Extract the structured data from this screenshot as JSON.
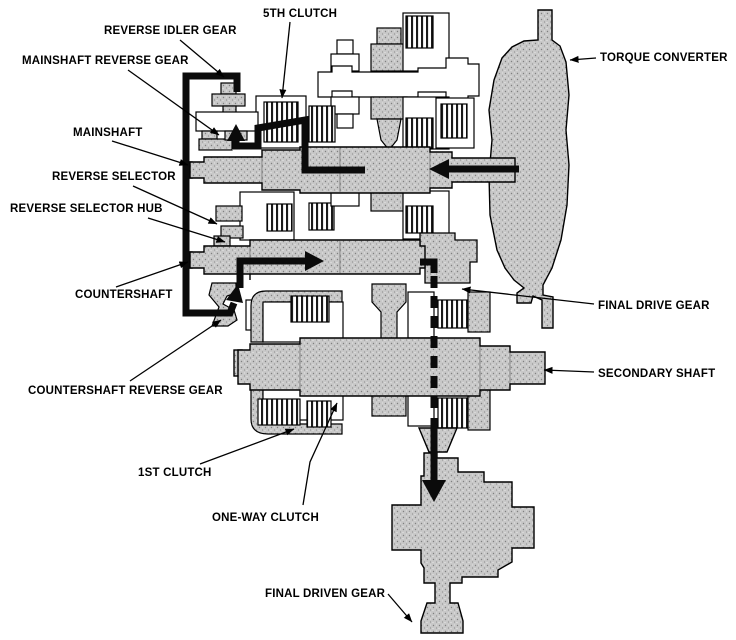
{
  "diagram": {
    "title": "Automatic transmission reverse power-flow cross-section",
    "colors": {
      "background": "#ffffff",
      "part_fill": "#c8c8c8",
      "outline": "#000000",
      "flow_arrow": "#000000"
    },
    "labels": [
      {
        "id": "reverse-idler-gear",
        "text": "REVERSE IDLER GEAR"
      },
      {
        "id": "5th-clutch",
        "text": "5TH CLUTCH"
      },
      {
        "id": "mainshaft-reverse-gear",
        "text": "MAINSHAFT REVERSE GEAR"
      },
      {
        "id": "mainshaft",
        "text": "MAINSHAFT"
      },
      {
        "id": "reverse-selector",
        "text": "REVERSE SELECTOR"
      },
      {
        "id": "reverse-selector-hub",
        "text": "REVERSE SELECTOR HUB"
      },
      {
        "id": "countershaft",
        "text": "COUNTERSHAFT"
      },
      {
        "id": "countershaft-reverse-gear",
        "text": "COUNTERSHAFT REVERSE GEAR"
      },
      {
        "id": "1st-clutch",
        "text": "1ST CLUTCH"
      },
      {
        "id": "one-way-clutch",
        "text": "ONE-WAY CLUTCH"
      },
      {
        "id": "torque-converter",
        "text": "TORQUE CONVERTER"
      },
      {
        "id": "final-drive-gear",
        "text": "FINAL DRIVE GEAR"
      },
      {
        "id": "secondary-shaft",
        "text": "SECONDARY SHAFT"
      },
      {
        "id": "final-driven-gear",
        "text": "FINAL DRIVEN GEAR"
      }
    ]
  }
}
